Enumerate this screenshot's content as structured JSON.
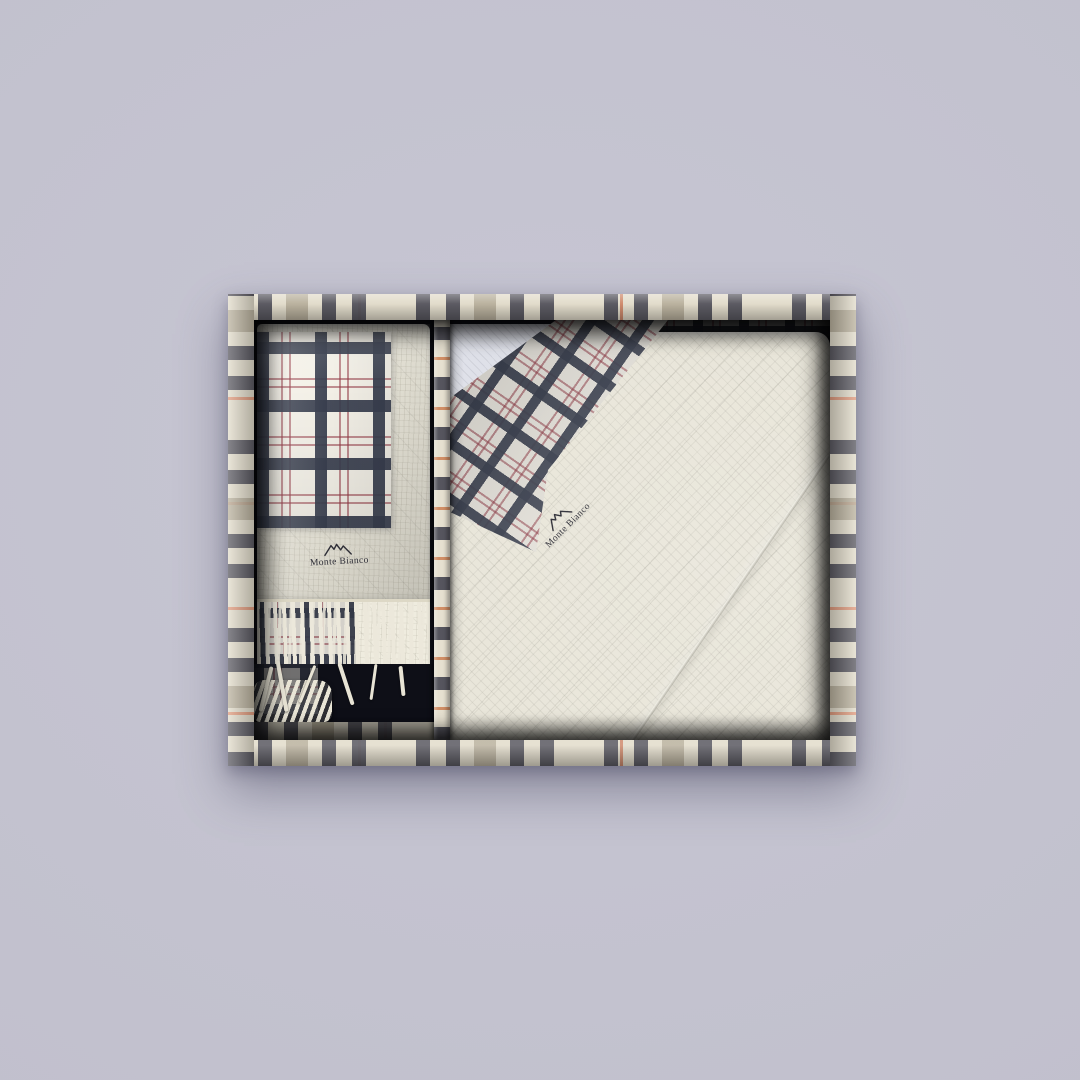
{
  "scene": {
    "background_color": "#c3c1cf",
    "subject": "gift box with two plaid-trimmed scarves"
  },
  "brand": {
    "name": "Monte Bianco",
    "icon": "mountain-peaks-icon"
  },
  "gift_box": {
    "frame_plaid": {
      "base": "#e2dccb",
      "dark_check": "#56555e",
      "tan_check": "#b1a894",
      "accent_red": "#cd8263"
    },
    "interior_color": "#15161f",
    "left_item": {
      "kind": "folded scarf with fringe",
      "logo_text": "Monte Bianco",
      "fabric_color": "#efecdf",
      "plaid_ground": "#f4f1e8",
      "plaid_band": "#3a414f",
      "plaid_accent": "#963c48"
    },
    "right_item": {
      "kind": "folded wrap with diagonal plaid border",
      "logo_text": "Monte Bianco",
      "fabric_color": "#e9e6da",
      "underlayer_color": "#dfe1e9"
    }
  }
}
